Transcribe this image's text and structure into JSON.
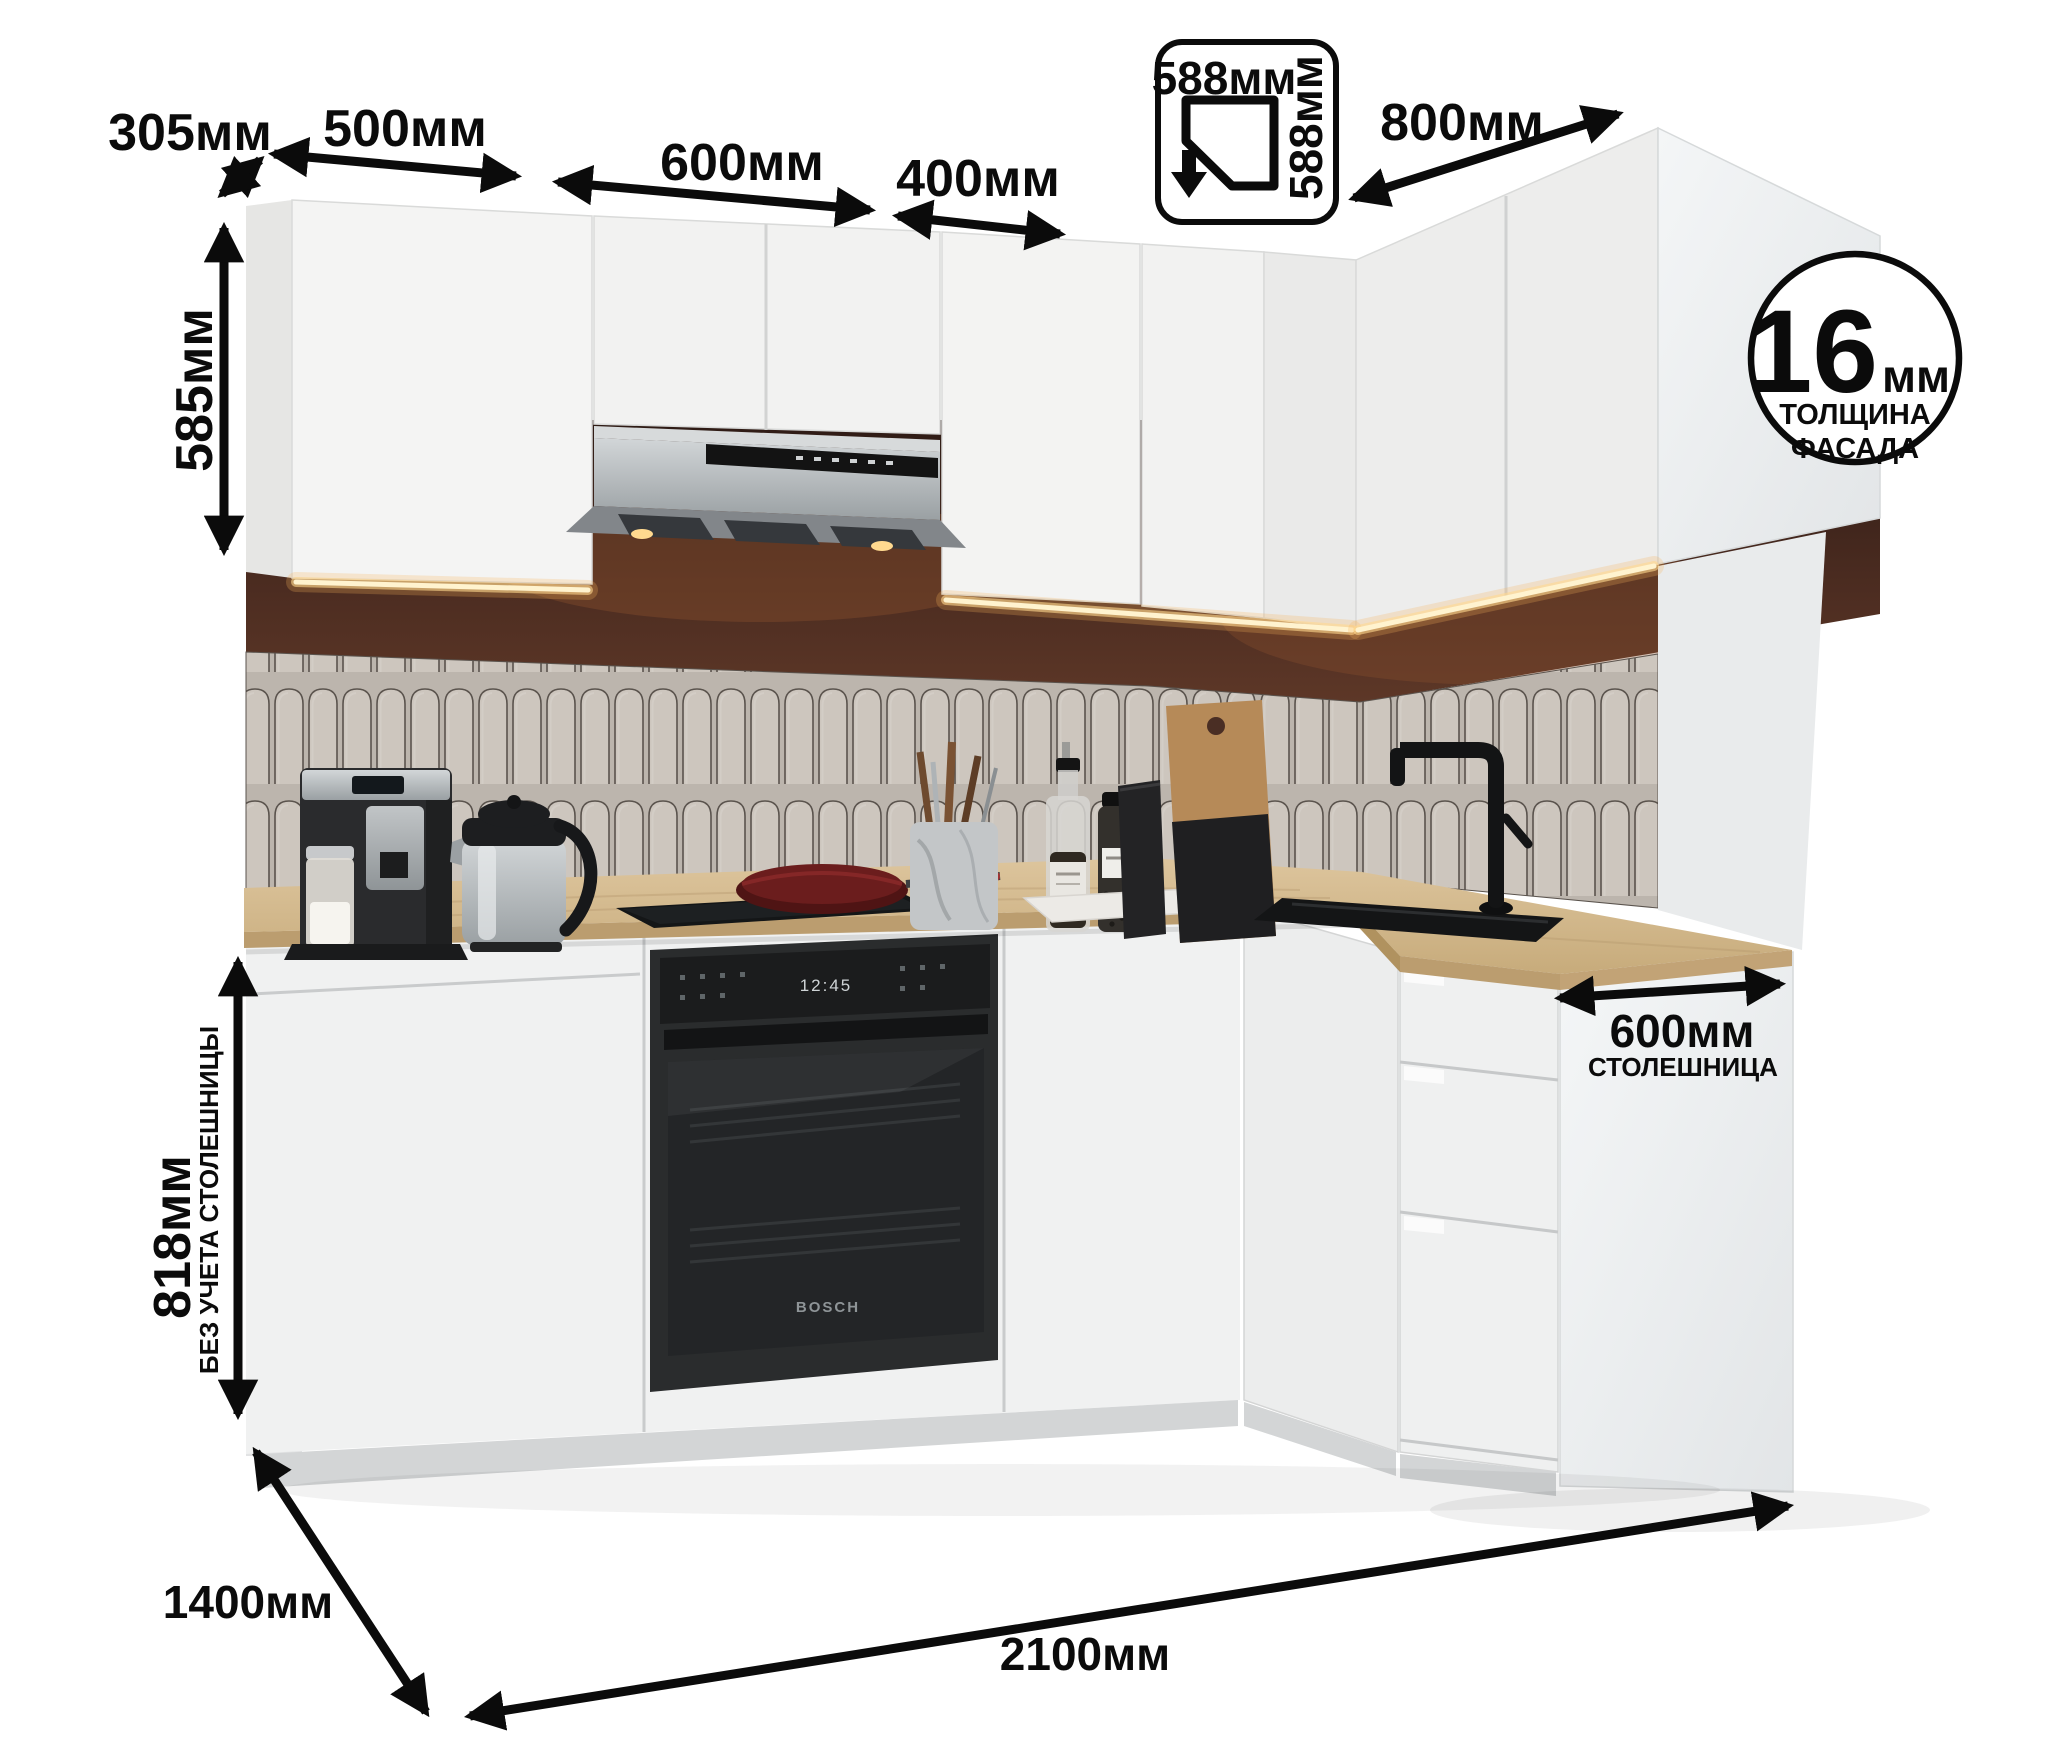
{
  "units": "мм",
  "colors": {
    "ink": "#0b0b0b",
    "cabinet_front": "#f2f2f1",
    "cabinet_side": "#e6e6e4",
    "countertop_wood": "#d5bc92",
    "backsplash_brown": "#42261d",
    "tile": "#cdc6be",
    "led_glow": "#ffd98f",
    "hood_steel": "#aeb2b5",
    "appliance_black": "#1d1e1f"
  },
  "dims": {
    "side_depth": "305мм",
    "wall_cab_1": "500мм",
    "wall_cab_2": "600мм",
    "wall_cab_3": "400мм",
    "corner_cab_width": "588мм",
    "corner_cab_depth": "588мм",
    "wall_cab_right": "800мм",
    "wall_cab_height": "585мм",
    "base_height": "818мм",
    "base_height_note": "БЕЗ УЧЕТА СТОЛЕШНИЦЫ",
    "countertop_depth": "600мм",
    "countertop_label": "СТОЛЕШНИЦА",
    "total_depth": "1400мм",
    "total_width": "2100мм",
    "facade_value": "16",
    "facade_unit": "мм",
    "facade_line1": "ТОЛЩИНА",
    "facade_line2": "ФАСАДА"
  },
  "appliances": {
    "oven_display": "12:45",
    "oven_brand": "BOSCH"
  }
}
